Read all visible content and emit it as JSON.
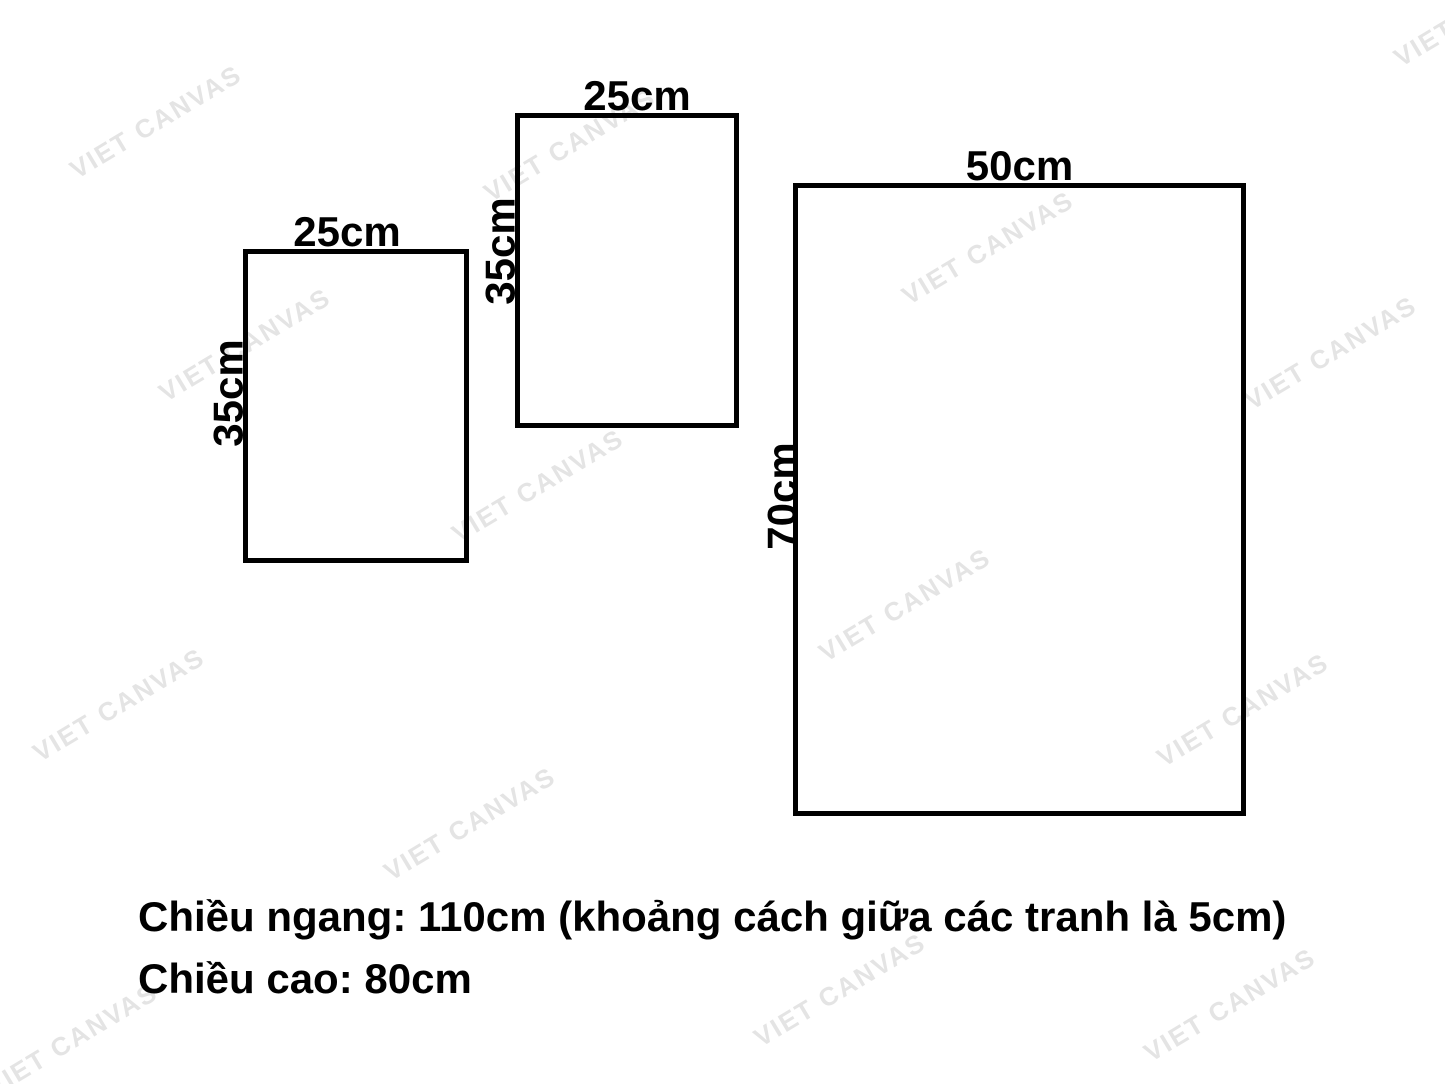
{
  "watermark": {
    "text": "VIET CANVAS"
  },
  "frames": [
    {
      "name": "frame-small-left",
      "width_label": "25cm",
      "height_label": "35cm"
    },
    {
      "name": "frame-small-top",
      "width_label": "25cm",
      "height_label": "35cm"
    },
    {
      "name": "frame-large-right",
      "width_label": "50cm",
      "height_label": "70cm"
    }
  ],
  "caption": {
    "line1": "Chiều ngang: 110cm (khoảng cách giữa các tranh là 5cm)",
    "line2": "Chiều cao: 80cm"
  },
  "colors": {
    "background": "#ffffff",
    "outline": "#000000",
    "label_text": "#000000",
    "watermark": "#e4e4e4"
  }
}
